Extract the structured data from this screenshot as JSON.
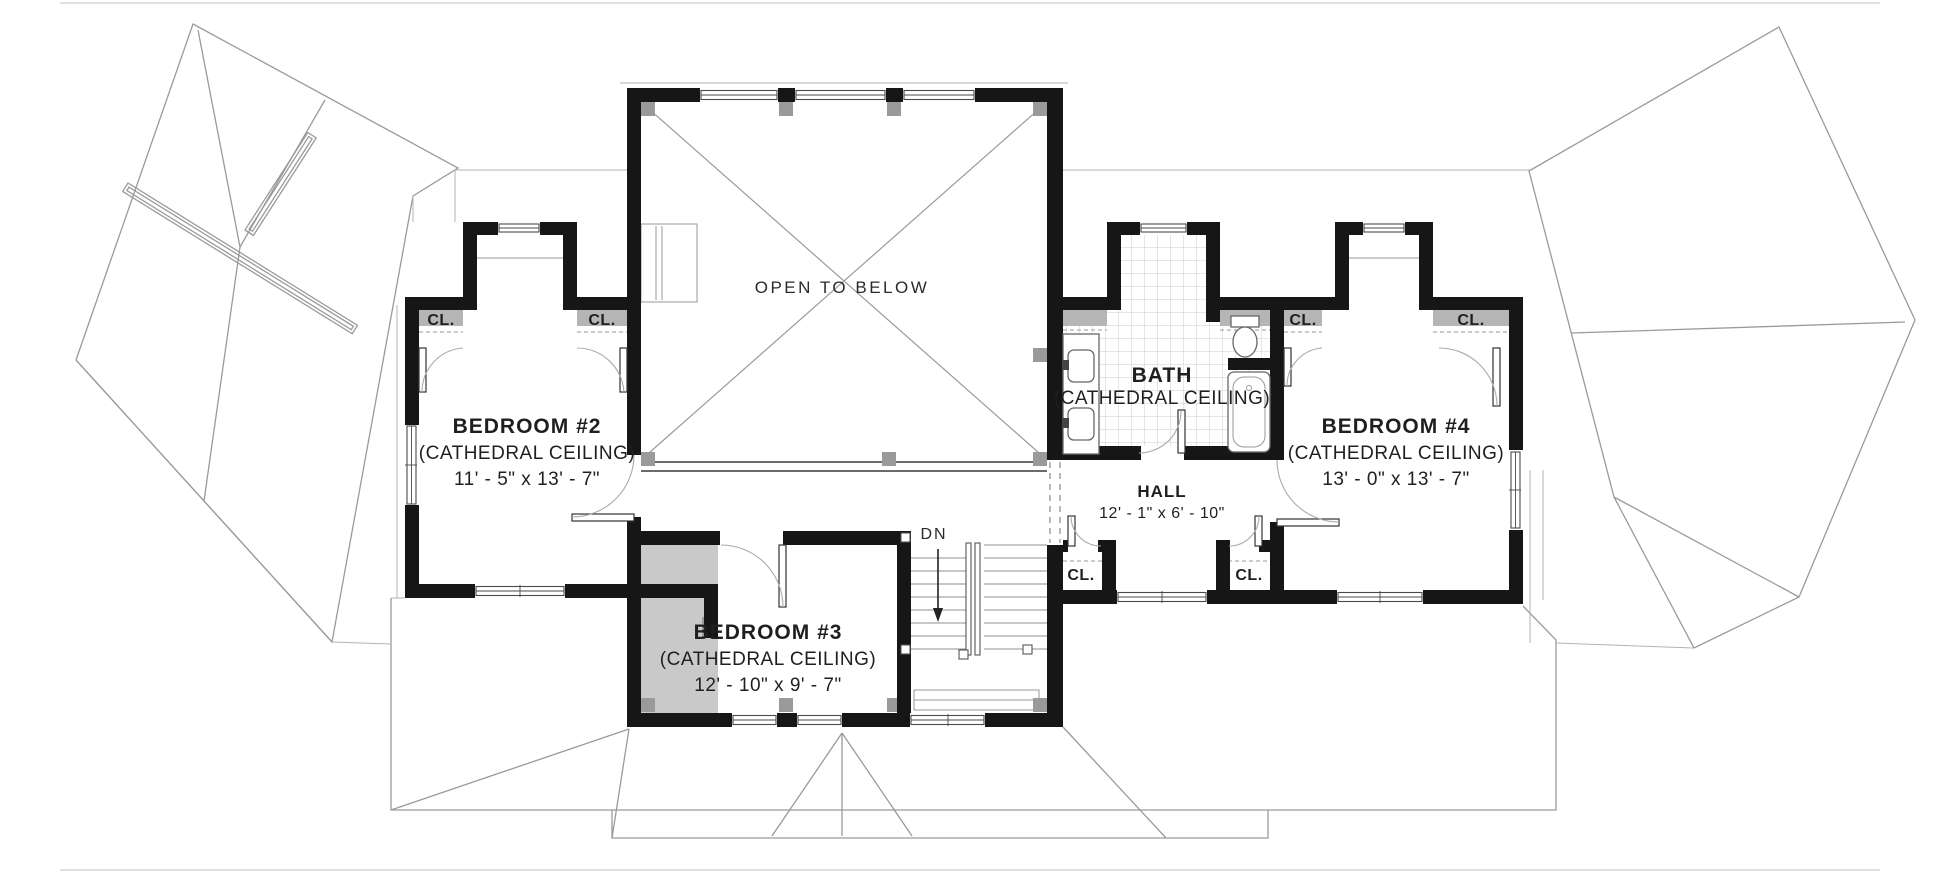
{
  "labels": {
    "open_to_below": "OPEN TO BELOW",
    "down": "DN",
    "closet": "CL."
  },
  "rooms": {
    "bedroom2": {
      "name": "BEDROOM #2",
      "ceiling": "(CATHEDRAL CEILING)",
      "dimensions": "11' - 5\" x 13' - 7\""
    },
    "bedroom3": {
      "name": "BEDROOM #3",
      "ceiling": "(CATHEDRAL CEILING)",
      "dimensions": "12' - 10\" x 9' - 7\""
    },
    "bedroom4": {
      "name": "BEDROOM #4",
      "ceiling": "(CATHEDRAL CEILING)",
      "dimensions": "13' - 0\" x 13' - 7\""
    },
    "bath": {
      "name": "BATH",
      "ceiling": "(CATHEDRAL CEILING)"
    },
    "hall": {
      "name": "HALL",
      "dimensions": "12' - 1\" x 6' - 10\""
    }
  },
  "colors": {
    "wall": "#161616",
    "room_shade": "#c9c9c9",
    "closet_shelf": "#b5b5b5",
    "tile_line": "#cccccc",
    "roof_line": "#9a9a9a",
    "text": "#1f1f1f"
  }
}
